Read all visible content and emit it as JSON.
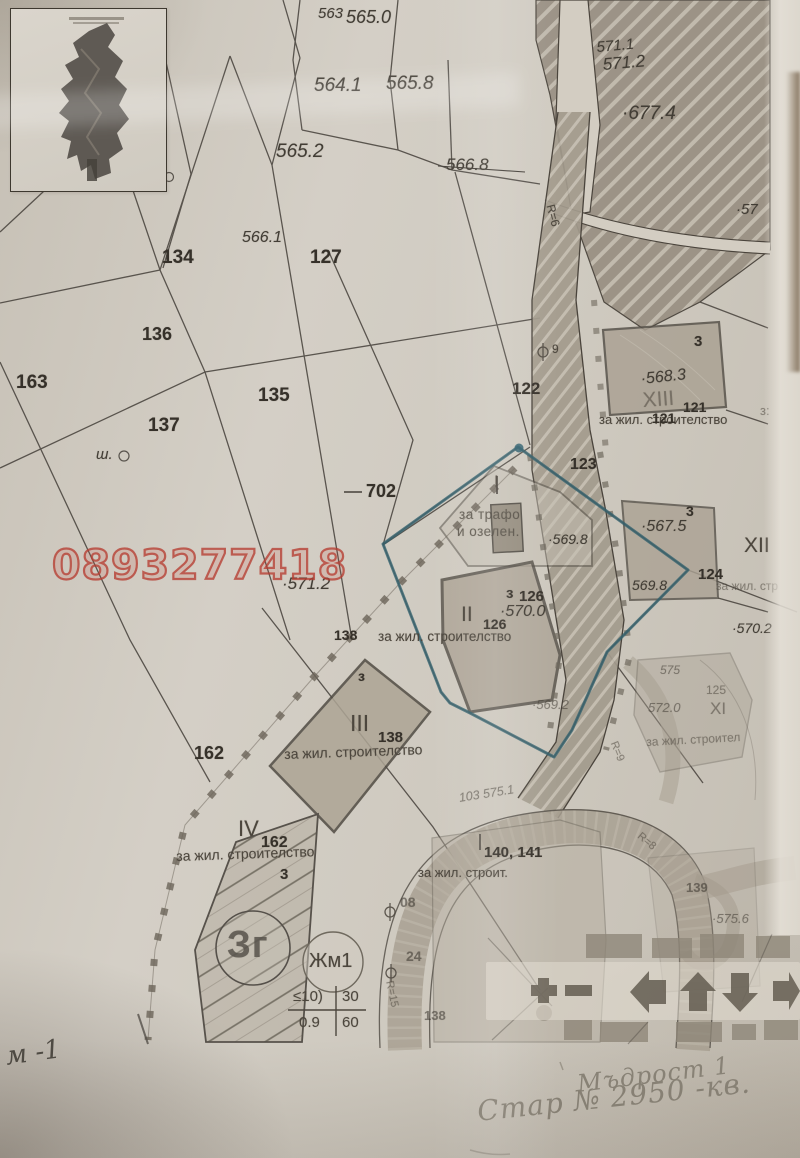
{
  "watermark": {
    "phone": "0893277418",
    "color": "#b63e32"
  },
  "legend_toolbar": {
    "icons": [
      "zoom-in",
      "zoom-out",
      "pan-left",
      "pan-up",
      "pan-down",
      "pan-right"
    ]
  },
  "map_labels": [
    {
      "text": "563",
      "x": 318,
      "y": 6,
      "fs": 15,
      "cls": "elev",
      "name": "elevation-label"
    },
    {
      "text": "565.0",
      "x": 346,
      "y": 8,
      "fs": 18,
      "cls": "elev",
      "name": "elevation-label"
    },
    {
      "text": "564.1",
      "x": 314,
      "y": 76,
      "fs": 19,
      "cls": "elev",
      "name": "elevation-label"
    },
    {
      "text": "565.8",
      "x": 386,
      "y": 74,
      "fs": 19,
      "cls": "elev",
      "name": "elevation-label"
    },
    {
      "text": "565.2",
      "x": 276,
      "y": 142,
      "fs": 19,
      "cls": "elev",
      "name": "elevation-label"
    },
    {
      "text": "566.8",
      "x": 446,
      "y": 156,
      "fs": 17,
      "cls": "elev",
      "name": "elevation-label"
    },
    {
      "text": "566.1",
      "x": 242,
      "y": 230,
      "fs": 16,
      "cls": "elev ital",
      "name": "elevation-label"
    },
    {
      "text": "571.1",
      "x": 596,
      "y": 40,
      "fs": 15,
      "rot": -5,
      "cls": "elev",
      "name": "elevation-label"
    },
    {
      "text": "571.2",
      "x": 602,
      "y": 56,
      "fs": 17,
      "rot": -5,
      "cls": "elev",
      "name": "elevation-label"
    },
    {
      "text": "·677.4",
      "x": 622,
      "y": 104,
      "fs": 19,
      "cls": "elev",
      "name": "elevation-label"
    },
    {
      "text": "·57",
      "x": 736,
      "y": 202,
      "fs": 15,
      "cls": "elev",
      "name": "elevation-label"
    },
    {
      "text": "·571.2",
      "x": 282,
      "y": 575,
      "fs": 17,
      "cls": "elev",
      "name": "elevation-label"
    },
    {
      "text": "·569.8",
      "x": 548,
      "y": 532,
      "fs": 14,
      "cls": "elev",
      "name": "elevation-label"
    },
    {
      "text": "·568.3",
      "x": 640,
      "y": 372,
      "fs": 16,
      "rot": -6,
      "cls": "elev",
      "name": "elevation-label"
    },
    {
      "text": "·567.5",
      "x": 641,
      "y": 519,
      "fs": 16,
      "cls": "elev",
      "name": "elevation-label"
    },
    {
      "text": "569.8",
      "x": 632,
      "y": 578,
      "fs": 14,
      "cls": "elev",
      "name": "elevation-label"
    },
    {
      "text": "·570.2",
      "x": 732,
      "y": 621,
      "fs": 14,
      "cls": "elev",
      "name": "elevation-label"
    },
    {
      "text": "·570.0",
      "x": 500,
      "y": 604,
      "fs": 16,
      "cls": "elev",
      "name": "elevation-label"
    },
    {
      "text": "·569.2",
      "x": 532,
      "y": 698,
      "fs": 13,
      "cls": "elev faint",
      "name": "elevation-label"
    },
    {
      "text": "572.0",
      "x": 648,
      "y": 701,
      "fs": 13,
      "cls": "elev faint",
      "name": "elevation-label"
    },
    {
      "text": "575",
      "x": 660,
      "y": 664,
      "fs": 12,
      "cls": "elev faint",
      "name": "elevation-label"
    },
    {
      "text": "·575.6",
      "x": 712,
      "y": 912,
      "fs": 13,
      "cls": "elev faint",
      "name": "elevation-label"
    },
    {
      "text": "103 575.1",
      "x": 458,
      "y": 792,
      "fs": 12.5,
      "rot": -9,
      "cls": "elev faint",
      "name": "street-survey-label"
    },
    {
      "text": "134",
      "x": 162,
      "y": 248,
      "fs": 19,
      "cls": "pnum",
      "name": "parcel-number"
    },
    {
      "text": "127",
      "x": 310,
      "y": 248,
      "fs": 19,
      "cls": "pnum",
      "name": "parcel-number"
    },
    {
      "text": "136",
      "x": 142,
      "y": 325,
      "fs": 18,
      "cls": "pnum",
      "name": "parcel-number"
    },
    {
      "text": "163",
      "x": 16,
      "y": 373,
      "fs": 19,
      "cls": "pnum",
      "name": "parcel-number"
    },
    {
      "text": "135",
      "x": 258,
      "y": 386,
      "fs": 19,
      "cls": "pnum",
      "name": "parcel-number"
    },
    {
      "text": "137",
      "x": 148,
      "y": 416,
      "fs": 19,
      "cls": "pnum",
      "name": "parcel-number"
    },
    {
      "text": "162",
      "x": 194,
      "y": 744,
      "fs": 18,
      "cls": "pnum",
      "name": "parcel-number"
    },
    {
      "text": "702",
      "x": 366,
      "y": 482,
      "fs": 18,
      "cls": "pnum",
      "name": "survey-point-label"
    },
    {
      "text": "122",
      "x": 512,
      "y": 380,
      "fs": 17,
      "cls": "pnum",
      "name": "parcel-number"
    },
    {
      "text": "123",
      "x": 570,
      "y": 457,
      "fs": 16,
      "cls": "pnum",
      "name": "parcel-number"
    },
    {
      "text": "ш.",
      "x": 96,
      "y": 447,
      "fs": 15,
      "cls": "elev ital",
      "name": "well-label"
    },
    {
      "text": "3",
      "x": 694,
      "y": 334,
      "fs": 15,
      "cls": "pnum",
      "name": "zone-number"
    },
    {
      "text": "XIII",
      "x": 642,
      "y": 390,
      "fs": 21,
      "rot": -4,
      "cls": "town faint",
      "name": "upi-roman-numeral"
    },
    {
      "text": "121",
      "x": 683,
      "y": 400,
      "fs": 14,
      "cls": "pnum",
      "name": "parcel-number"
    },
    {
      "text": "за жил. строителство",
      "x": 599,
      "y": 413,
      "fs": 13,
      "cls": "town",
      "name": "landuse-label"
    },
    {
      "text": "121",
      "x": 652,
      "y": 411,
      "fs": 14,
      "cls": "pnum",
      "name": "parcel-number"
    },
    {
      "text": "з:",
      "x": 760,
      "y": 404,
      "fs": 13,
      "cls": "town faint",
      "name": "zone-number"
    },
    {
      "text": "9",
      "x": 552,
      "y": 343,
      "fs": 12,
      "cls": "town",
      "name": "survey-point-label"
    },
    {
      "text": "3",
      "x": 686,
      "y": 504,
      "fs": 14,
      "cls": "pnum",
      "name": "zone-number"
    },
    {
      "text": "XII",
      "x": 744,
      "y": 535,
      "fs": 21,
      "cls": "town",
      "name": "upi-roman-numeral"
    },
    {
      "text": "124",
      "x": 698,
      "y": 567,
      "fs": 15,
      "cls": "pnum",
      "name": "parcel-number"
    },
    {
      "text": "за жил. стр",
      "x": 716,
      "y": 580,
      "fs": 12,
      "cls": "town faint",
      "name": "landuse-label"
    },
    {
      "text": "125",
      "x": 706,
      "y": 684,
      "fs": 12,
      "cls": "town faint",
      "name": "parcel-number"
    },
    {
      "text": "XI",
      "x": 710,
      "y": 700,
      "fs": 17,
      "cls": "town faint",
      "name": "upi-roman-numeral"
    },
    {
      "text": "за жил. строител",
      "x": 646,
      "y": 736,
      "fs": 12,
      "rot": -3,
      "cls": "town faint",
      "name": "landuse-label"
    },
    {
      "text": "I",
      "x": 494,
      "y": 473,
      "fs": 17,
      "cls": "town",
      "name": "upi-roman-numeral"
    },
    {
      "text": "за трафо",
      "x": 459,
      "y": 508,
      "fs": 13.5,
      "cls": "town soft",
      "name": "landuse-label"
    },
    {
      "text": "и озелен.",
      "x": 457,
      "y": 525,
      "fs": 13.5,
      "cls": "town soft",
      "name": "landuse-label"
    },
    {
      "text": "з",
      "x": 506,
      "y": 586,
      "fs": 15,
      "cls": "pnum",
      "name": "zone-number"
    },
    {
      "text": "126",
      "x": 519,
      "y": 589,
      "fs": 15,
      "cls": "pnum",
      "name": "parcel-number"
    },
    {
      "text": "II",
      "x": 461,
      "y": 604,
      "fs": 21,
      "cls": "town",
      "name": "upi-roman-numeral"
    },
    {
      "text": "126",
      "x": 483,
      "y": 617,
      "fs": 14,
      "cls": "pnum",
      "name": "parcel-number"
    },
    {
      "text": "138",
      "x": 334,
      "y": 628,
      "fs": 14,
      "cls": "pnum",
      "name": "parcel-number"
    },
    {
      "text": "за жил. строителство",
      "x": 378,
      "y": 630,
      "fs": 13.5,
      "cls": "town",
      "name": "landuse-label"
    },
    {
      "text": "з",
      "x": 358,
      "y": 669,
      "fs": 14,
      "cls": "pnum",
      "name": "zone-number"
    },
    {
      "text": "III",
      "x": 350,
      "y": 712,
      "fs": 23,
      "cls": "town",
      "name": "upi-roman-numeral"
    },
    {
      "text": "138",
      "x": 378,
      "y": 730,
      "fs": 15,
      "cls": "pnum",
      "name": "parcel-number"
    },
    {
      "text": "за жил. строителство",
      "x": 284,
      "y": 747,
      "fs": 14,
      "rot": -2,
      "cls": "town",
      "name": "landuse-label"
    },
    {
      "text": "IV",
      "x": 238,
      "y": 818,
      "fs": 22,
      "cls": "town",
      "name": "upi-roman-numeral"
    },
    {
      "text": "162",
      "x": 261,
      "y": 835,
      "fs": 16,
      "cls": "pnum",
      "name": "parcel-number"
    },
    {
      "text": "за жил. строителство",
      "x": 176,
      "y": 849,
      "fs": 14,
      "rot": -2,
      "cls": "town",
      "name": "landuse-label"
    },
    {
      "text": "3",
      "x": 280,
      "y": 867,
      "fs": 15,
      "cls": "pnum",
      "name": "zone-number"
    },
    {
      "text": "Зг",
      "x": 227,
      "y": 926,
      "fs": 38,
      "cls": "big",
      "name": "zone-circle-label"
    },
    {
      "text": "Жм1",
      "x": 309,
      "y": 951,
      "fs": 20,
      "cls": "town",
      "name": "zone-circle-label"
    },
    {
      "text": "≤10)",
      "x": 293,
      "y": 989,
      "fs": 15,
      "cls": "town",
      "name": "zoning-parameter"
    },
    {
      "text": "30",
      "x": 342,
      "y": 989,
      "fs": 15,
      "cls": "town",
      "name": "zoning-parameter"
    },
    {
      "text": "0.9",
      "x": 299,
      "y": 1015,
      "fs": 15,
      "cls": "town",
      "name": "zoning-parameter"
    },
    {
      "text": "60",
      "x": 342,
      "y": 1015,
      "fs": 15,
      "cls": "town",
      "name": "zoning-parameter"
    },
    {
      "text": "140, 141",
      "x": 484,
      "y": 845,
      "fs": 15,
      "cls": "pnum",
      "name": "parcel-number"
    },
    {
      "text": "за жил. строит.",
      "x": 418,
      "y": 866,
      "fs": 13,
      "cls": "town",
      "name": "landuse-label"
    },
    {
      "text": "08",
      "x": 400,
      "y": 895,
      "fs": 14,
      "cls": "pnum faint",
      "name": "parcel-number"
    },
    {
      "text": "24",
      "x": 406,
      "y": 949,
      "fs": 14,
      "cls": "pnum faint",
      "name": "parcel-number"
    },
    {
      "text": "138",
      "x": 424,
      "y": 1009,
      "fs": 13,
      "cls": "pnum faint",
      "name": "parcel-number"
    },
    {
      "text": "139",
      "x": 686,
      "y": 881,
      "fs": 13,
      "cls": "pnum faint",
      "name": "parcel-number"
    },
    {
      "text": "R=6",
      "x": 556,
      "y": 203,
      "fs": 12,
      "rot": 75,
      "cls": "town",
      "name": "road-radius-label"
    },
    {
      "text": "R=9",
      "x": 618,
      "y": 740,
      "fs": 11,
      "rot": 68,
      "cls": "town faint",
      "name": "road-radius-label"
    },
    {
      "text": "R=8",
      "x": 642,
      "y": 831,
      "fs": 11,
      "rot": 40,
      "cls": "town faint",
      "name": "road-radius-label"
    },
    {
      "text": "R=15",
      "x": 394,
      "y": 980,
      "fs": 11,
      "rot": 78,
      "cls": "town faint",
      "name": "road-radius-label"
    },
    {
      "text": "м -1",
      "x": 4,
      "y": 1044,
      "fs": 26,
      "rot": -8,
      "cls": "pen",
      "name": "handwritten-note"
    },
    {
      "text": "Мъдрост 1",
      "x": 576,
      "y": 1072,
      "fs": 24,
      "rot": -7,
      "cls": "pencil",
      "name": "handwritten-note"
    },
    {
      "text": "Стар № 2950 -кв.",
      "x": 476,
      "y": 1098,
      "fs": 28,
      "rot": -6,
      "cls": "pencil",
      "name": "handwritten-note"
    }
  ]
}
